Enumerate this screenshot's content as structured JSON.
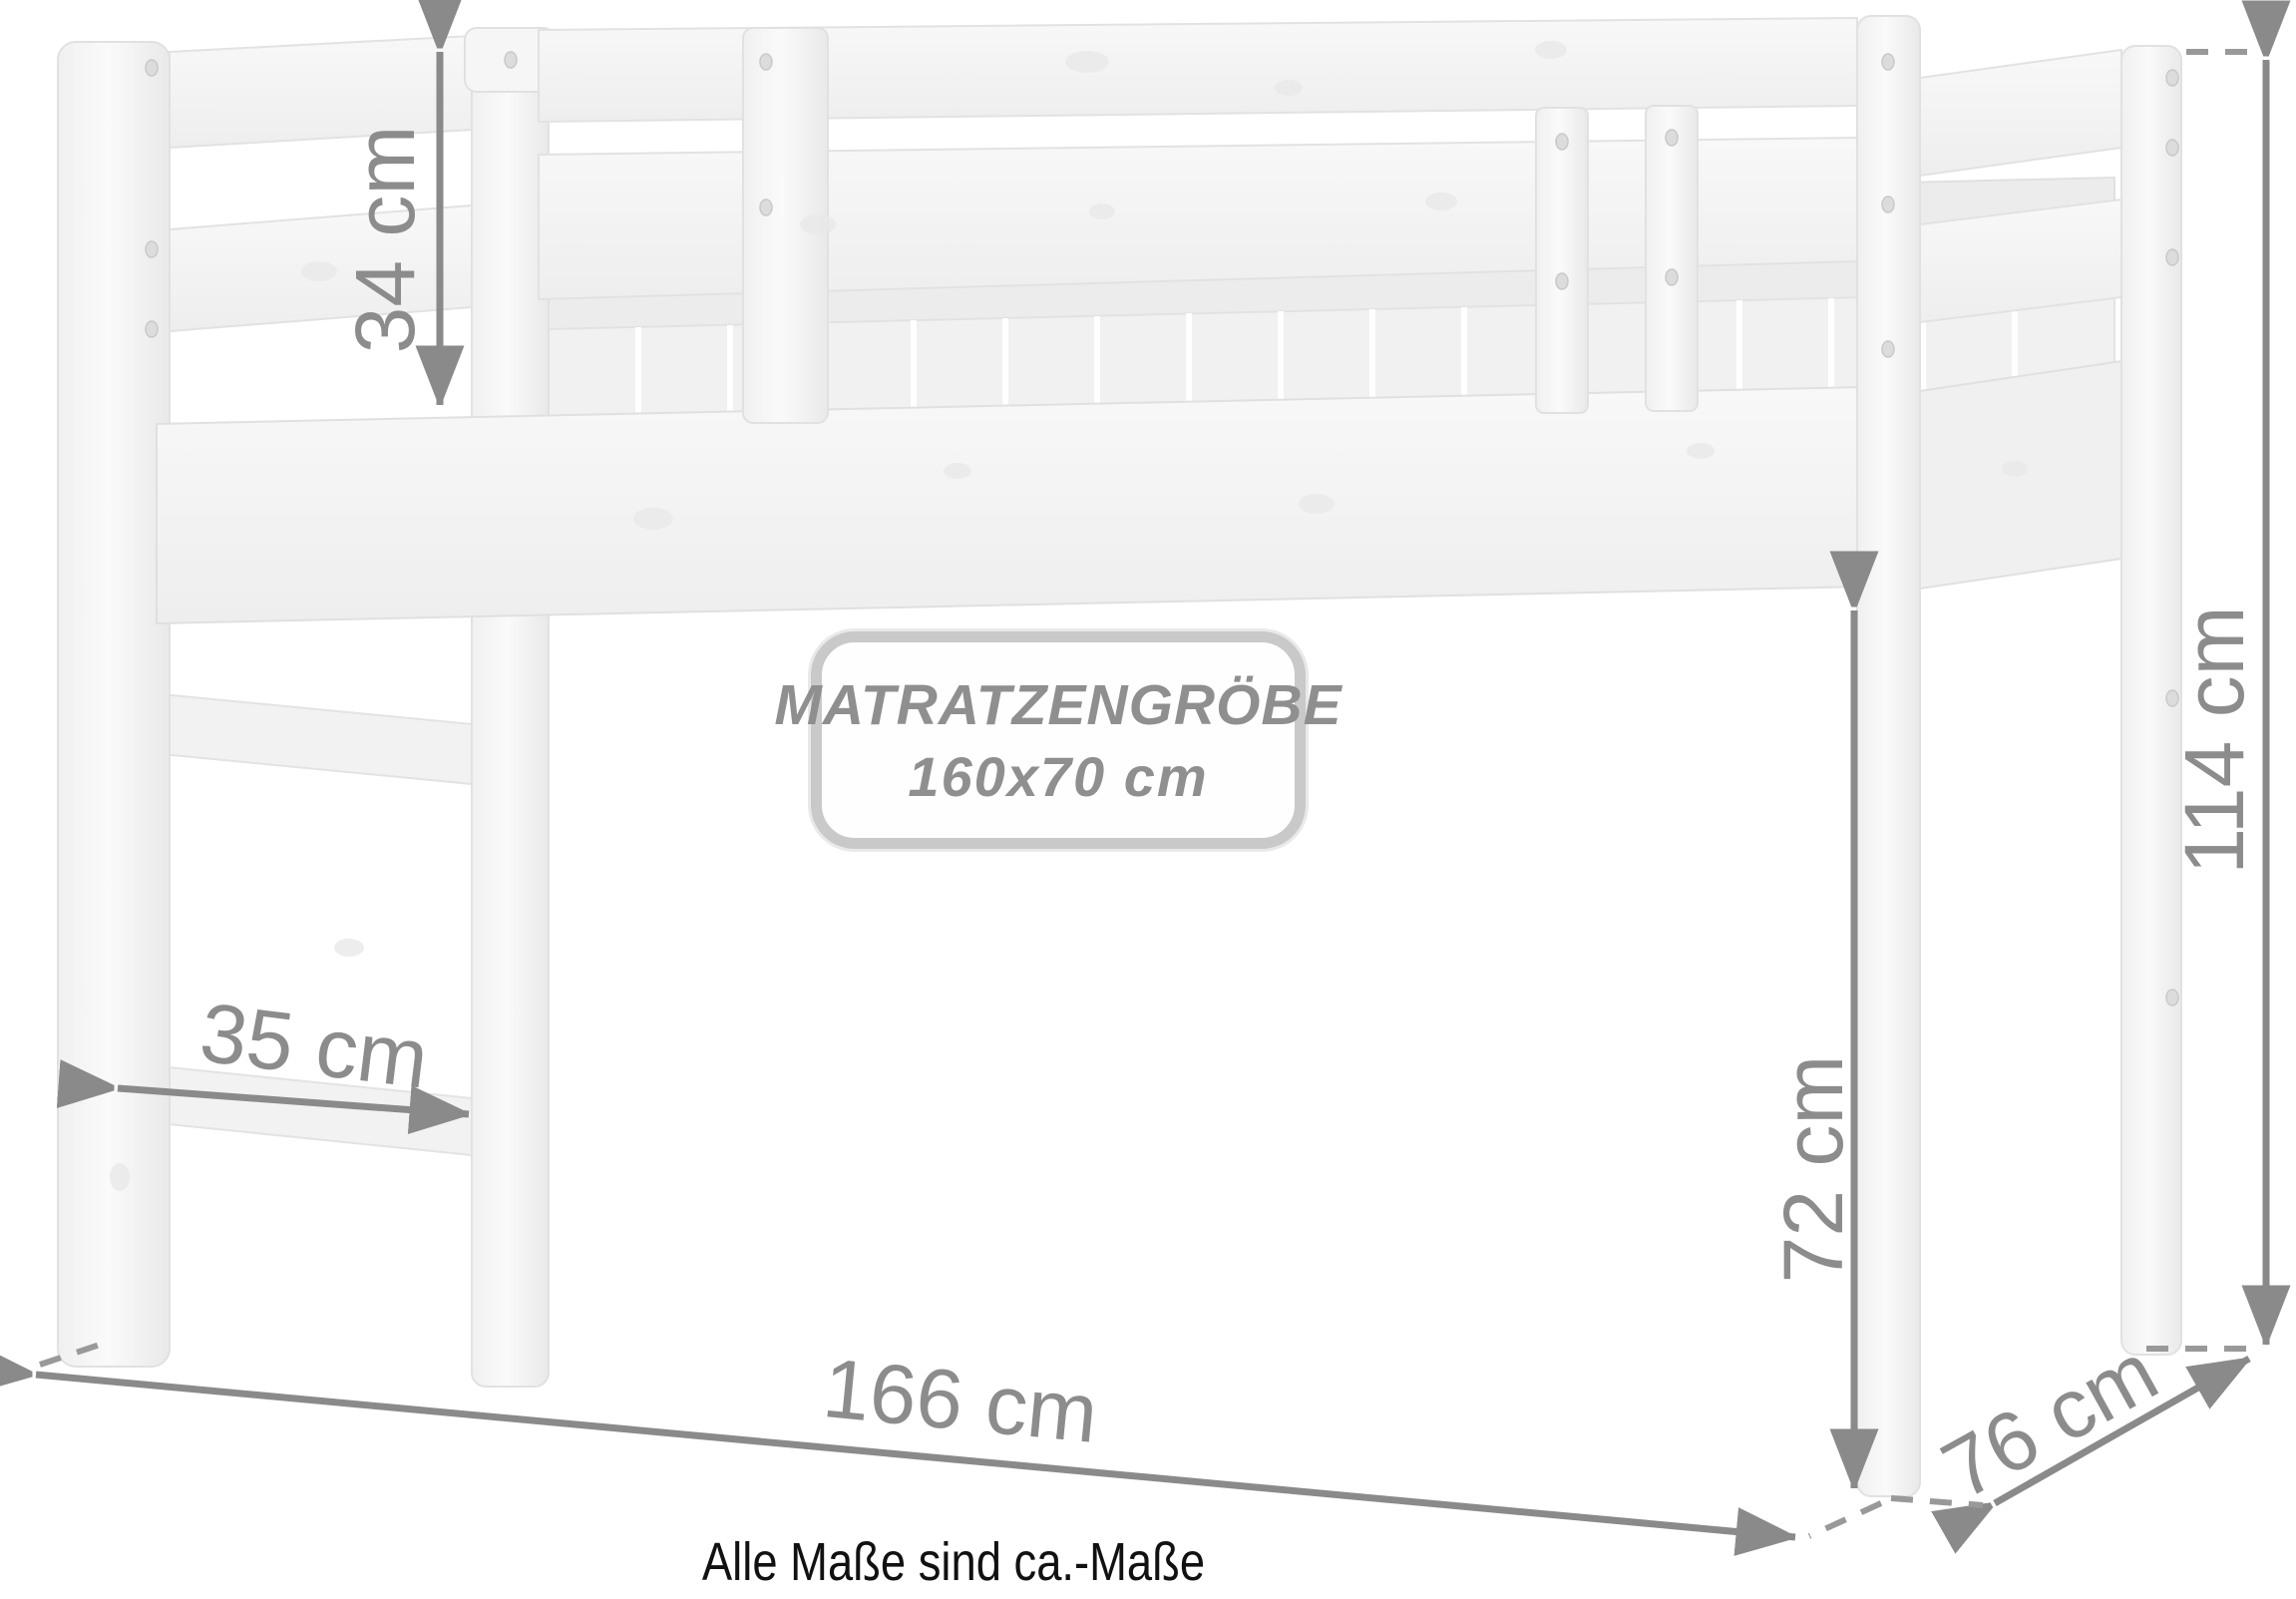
{
  "diagram": {
    "dimensions": {
      "guard_rail_height": "34 cm",
      "ladder_step_width": "35 cm",
      "bed_length": "166 cm",
      "bed_depth": "76 cm",
      "under_bed_clearance": "72 cm",
      "total_height": "114 cm"
    },
    "badge": {
      "line1": "MATRATZENGRÖBE",
      "line2": "160x70 cm"
    },
    "footnote": "Alle Maße sind ca.-Maße",
    "colors": {
      "dimension_gray": "#8c8c8c",
      "dash_gray": "#999999",
      "wood_fill": "#f4f4f4",
      "wood_edge": "#e2e2e2",
      "badge_border": "#c9c9c9",
      "badge_text": "#8f8f8f",
      "footnote_text": "#111111"
    }
  }
}
